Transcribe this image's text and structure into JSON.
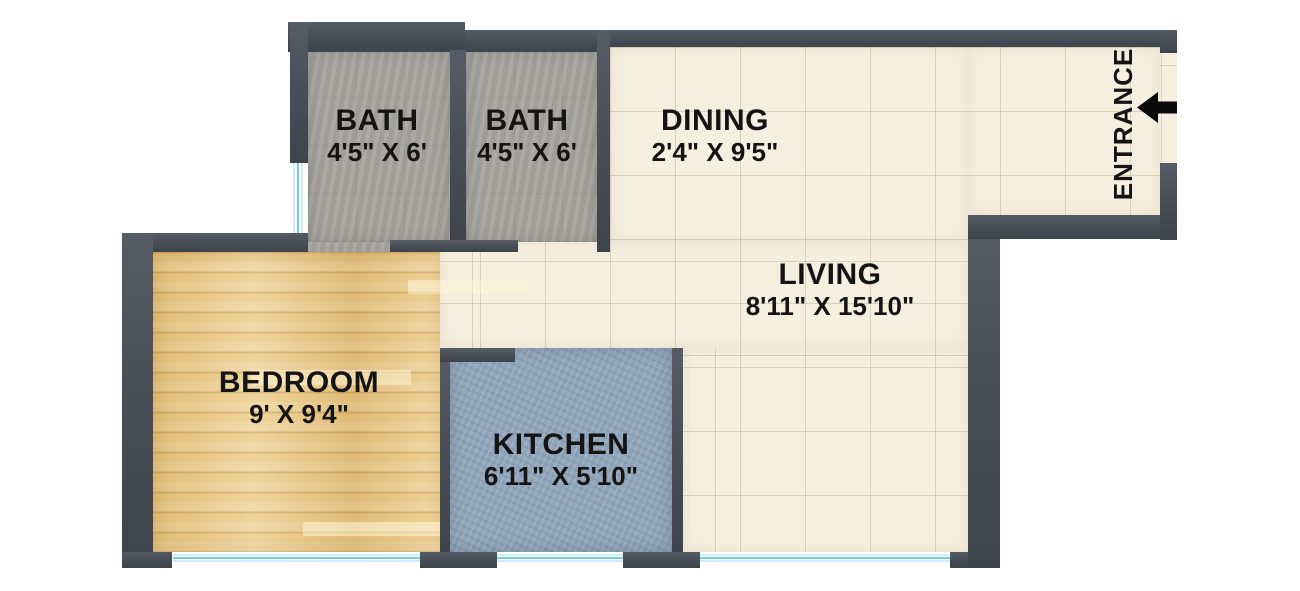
{
  "plan": {
    "colors": {
      "background": "#ffffff",
      "wall": "#474d56",
      "window": "#6fcfe2",
      "bath_tile": "#a8a5a0",
      "cream_tile": "#f5efdf",
      "wood": "#e9cb8d",
      "kitchen_tile": "#92a6bb",
      "label": "#141414"
    },
    "rooms": [
      {
        "name": "BATH",
        "dims": "4'5\" X 6'",
        "floor": "gray-tile"
      },
      {
        "name": "BATH",
        "dims": "4'5\" X 6'",
        "floor": "gray-tile"
      },
      {
        "name": "DINING",
        "dims": "2'4\" X 9'5\"",
        "floor": "cream-tile"
      },
      {
        "name": "LIVING",
        "dims": "8'11\" X 15'10\"",
        "floor": "cream-tile"
      },
      {
        "name": "BEDROOM",
        "dims": "9' X 9'4\"",
        "floor": "wood"
      },
      {
        "name": "KITCHEN",
        "dims": "6'11\" X 5'10\"",
        "floor": "blue-tile"
      }
    ],
    "entrance": {
      "label": "ENTRANCE",
      "arrow": "left"
    }
  }
}
